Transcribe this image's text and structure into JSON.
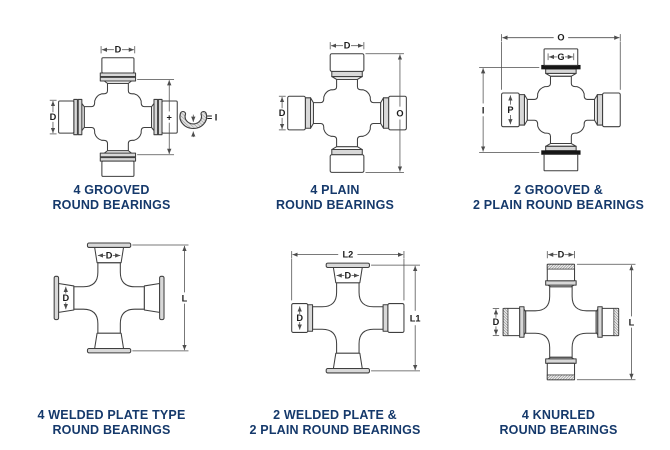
{
  "colors": {
    "line": "#3f3f3f",
    "dim": "#4d4d4d",
    "shade": "#d8d8d8",
    "ring_black": "#161616",
    "caption": "#15396b",
    "label": "#1c1c1c",
    "background": "#ffffff"
  },
  "diagrams": [
    {
      "id": "4-grooved-round-bearings",
      "caption": [
        "4 GROOVED",
        "ROUND BEARINGS"
      ],
      "labels": {
        "top_d": "D",
        "left_d": "D",
        "plus": "+",
        "equals_i": "= I"
      }
    },
    {
      "id": "4-plain-round-bearings",
      "caption": [
        "4 PLAIN",
        "ROUND BEARINGS"
      ],
      "labels": {
        "top_d": "D",
        "left_d": "D",
        "right_o": "O"
      }
    },
    {
      "id": "2-grooved-2-plain-round-bearings",
      "caption": [
        "2 GROOVED &",
        "2 PLAIN ROUND BEARINGS"
      ],
      "labels": {
        "top_o": "O",
        "cap_g": "G",
        "left_i": "I",
        "cap_p": "P"
      }
    },
    {
      "id": "4-welded-plate-type-round-bearings",
      "caption": [
        "4 WELDED PLATE TYPE",
        "ROUND BEARINGS"
      ],
      "labels": {
        "cap_top_d": "D",
        "cap_left_d": "D",
        "right_l": "L"
      }
    },
    {
      "id": "2-welded-plate-2-plain-round-bearings",
      "caption": [
        "2 WELDED PLATE &",
        "2 PLAIN ROUND BEARINGS"
      ],
      "labels": {
        "top_l2": "L2",
        "cap_top_d": "D",
        "cap_left_d": "D",
        "right_l1": "L1"
      }
    },
    {
      "id": "4-knurled-round-bearings",
      "caption": [
        "4 KNURLED",
        "ROUND BEARINGS"
      ],
      "labels": {
        "top_d": "D",
        "left_d": "D",
        "right_l": "L"
      }
    }
  ]
}
